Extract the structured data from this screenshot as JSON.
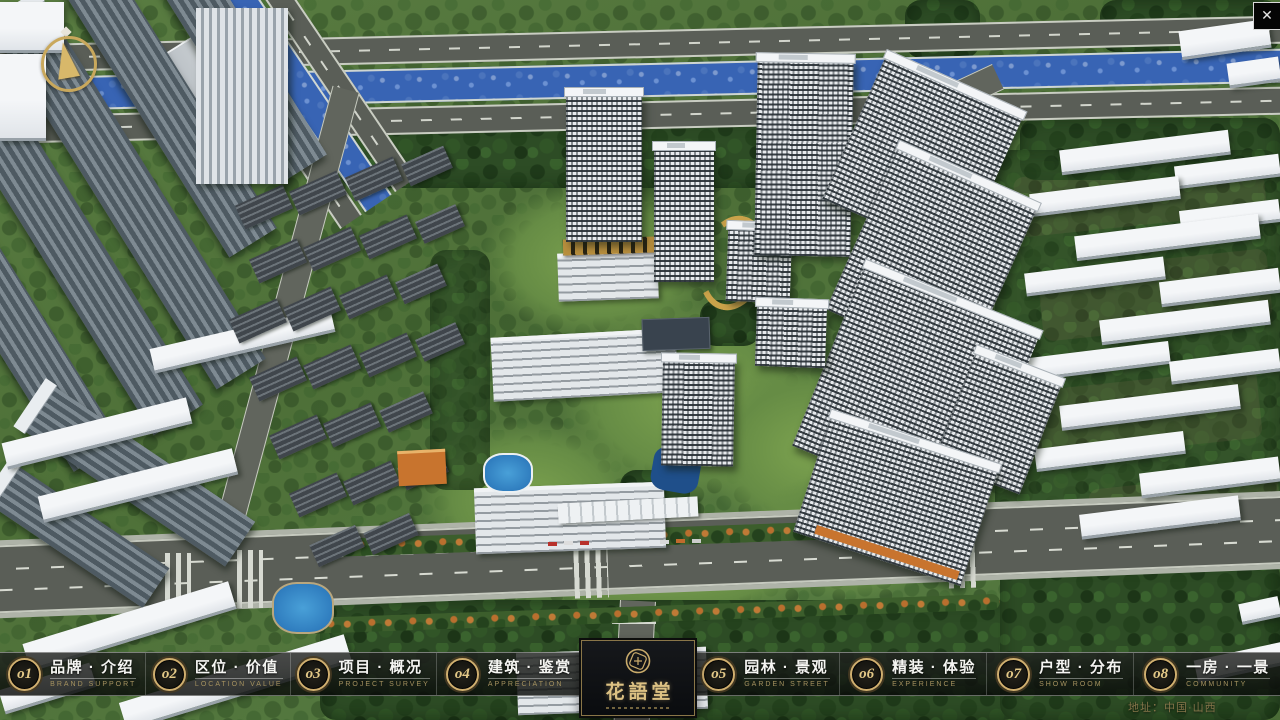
{
  "window": {
    "close_glyph": "✕"
  },
  "nav": {
    "items": [
      {
        "num": "o1",
        "zh": "品牌 · 介绍",
        "en": "BRAND SUPPORT"
      },
      {
        "num": "o2",
        "zh": "区位 · 价值",
        "en": "LOCATION VALUE"
      },
      {
        "num": "o3",
        "zh": "项目 · 概况",
        "en": "PROJECT SURVEY"
      },
      {
        "num": "o4",
        "zh": "建筑 · 鉴赏",
        "en": "APPRECIATION"
      },
      {
        "num": "o5",
        "zh": "园林 · 景观",
        "en": "GARDEN STREET"
      },
      {
        "num": "o6",
        "zh": "精装 · 体验",
        "en": "EXPERIENCE"
      },
      {
        "num": "o7",
        "zh": "户型 · 分布",
        "en": "SHOW ROOM"
      },
      {
        "num": "o8",
        "zh": "一房 · 一景",
        "en": "COMMUNITY"
      }
    ]
  },
  "logo": {
    "title": "花語堂"
  },
  "footer": {
    "address": "地址：中国·山西"
  },
  "colors": {
    "gold_accent": "#cfae6e",
    "gold_text": "#dcc183",
    "nav_bg": "rgba(12,14,13,0.8)",
    "river_blue": "#3864b4",
    "address_gold": "#85754a"
  }
}
